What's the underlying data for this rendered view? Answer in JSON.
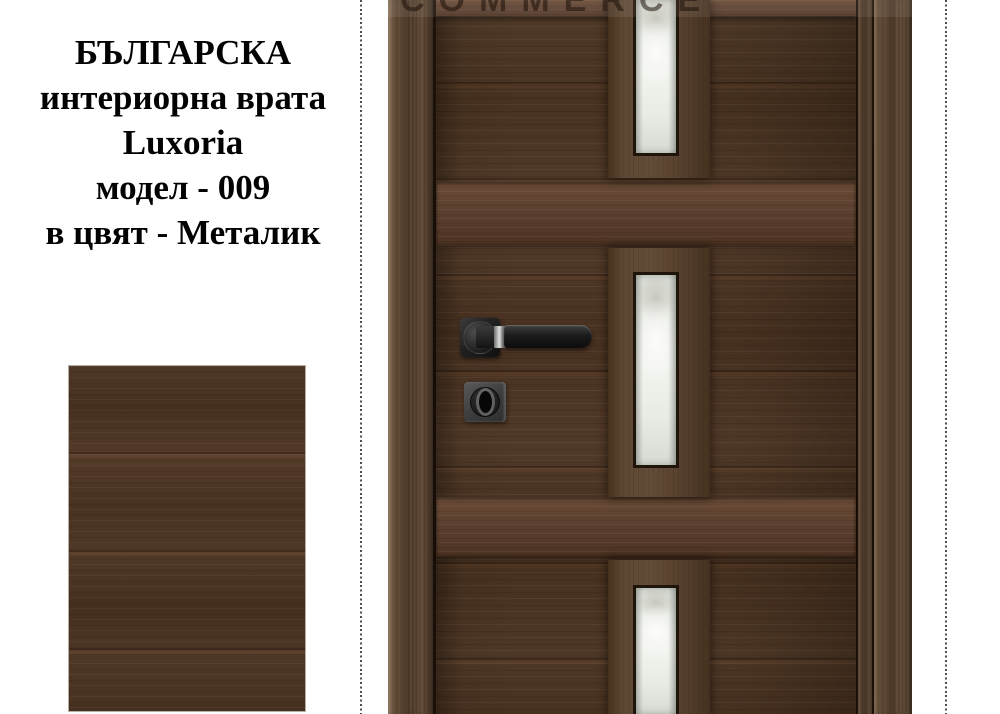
{
  "product_info": {
    "origin": "БЪЛГАРСКА",
    "type": "интериорна врата",
    "brand": "Luxoria",
    "model": "модел - 009",
    "color": "в цвят - Металик"
  },
  "watermark_text": "COMMERCE",
  "door": {
    "glass_panels_count": 3,
    "hardware": [
      "lever-handle",
      "keyhole"
    ]
  },
  "colors": {
    "background": "#ffffff",
    "text": "#030303",
    "wood_base": "#4a3424",
    "wood_rail": "#5c402d",
    "wood_frame": "#57422f",
    "wood_panel": "#5a4431",
    "glass": "#eaede7",
    "handle_black": "#1b1b1b",
    "handle_chrome": "#c9c9c9",
    "keyhole_plate": "#474747",
    "guide_line": "#4f4f4f",
    "swatch_border": "#b6aea5"
  }
}
